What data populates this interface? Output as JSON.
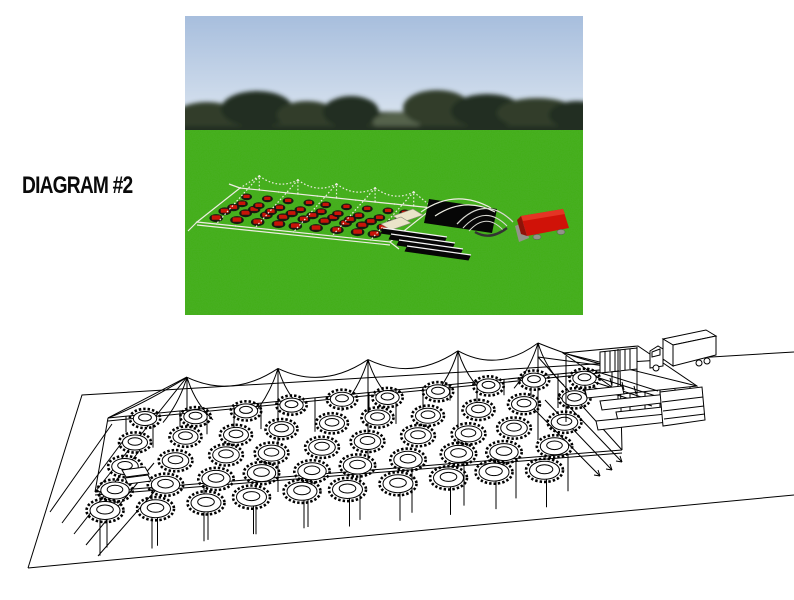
{
  "page": {
    "title": "DIAGRAM #2"
  },
  "colors": {
    "page_bg": "#ffffff",
    "label_text": "#0a0a0a",
    "line": "#000000",
    "sky_top": "#a7bedd",
    "sky_bottom": "#eef2f6",
    "trees": "#303d2c",
    "trees_dark": "#222e20",
    "trees_light": "#55624c",
    "grass": "#41ae14",
    "tent_frame": "#eeede3",
    "table_red": "#c81408",
    "chair_black": "#161310",
    "buffet_cream": "#eae4c9",
    "stage_black": "#060606",
    "step_white": "#f5f5f5",
    "dome_gray": "#d8d8d2",
    "truck_red": "#d01208",
    "truck_red_light": "#e43424",
    "wheel_gray": "#93938a"
  },
  "photo": {
    "name": "3d-render-preview",
    "alt": "3D render of a frame tent with red tables and black chairs, buffet tables, black stage with steps, dome frame and red box truck on a green field with a treeline",
    "elements": [
      "sky",
      "treeline",
      "grass-field",
      "frame-tent",
      "red-tables-with-chairs",
      "buffet-tables",
      "stage",
      "stage-steps",
      "dome-frame",
      "box-truck"
    ],
    "table_grid": {
      "columns": 9,
      "rows": 5
    }
  },
  "wireframe": {
    "name": "cad-wireframe-drawing",
    "alt": "Black and white wireframe drawing of the same pole tent layout with round tables and chairs, stage structure, stairs and box truck on a ground plane",
    "elements": [
      "ground-plane",
      "pole-tent-frame",
      "guy-ropes",
      "round-tables",
      "chair-rings",
      "stage-structure",
      "stairs",
      "platform-planks",
      "box-truck"
    ],
    "table_grid": {
      "columns": 10,
      "rows": 5
    },
    "peaks": 5
  }
}
